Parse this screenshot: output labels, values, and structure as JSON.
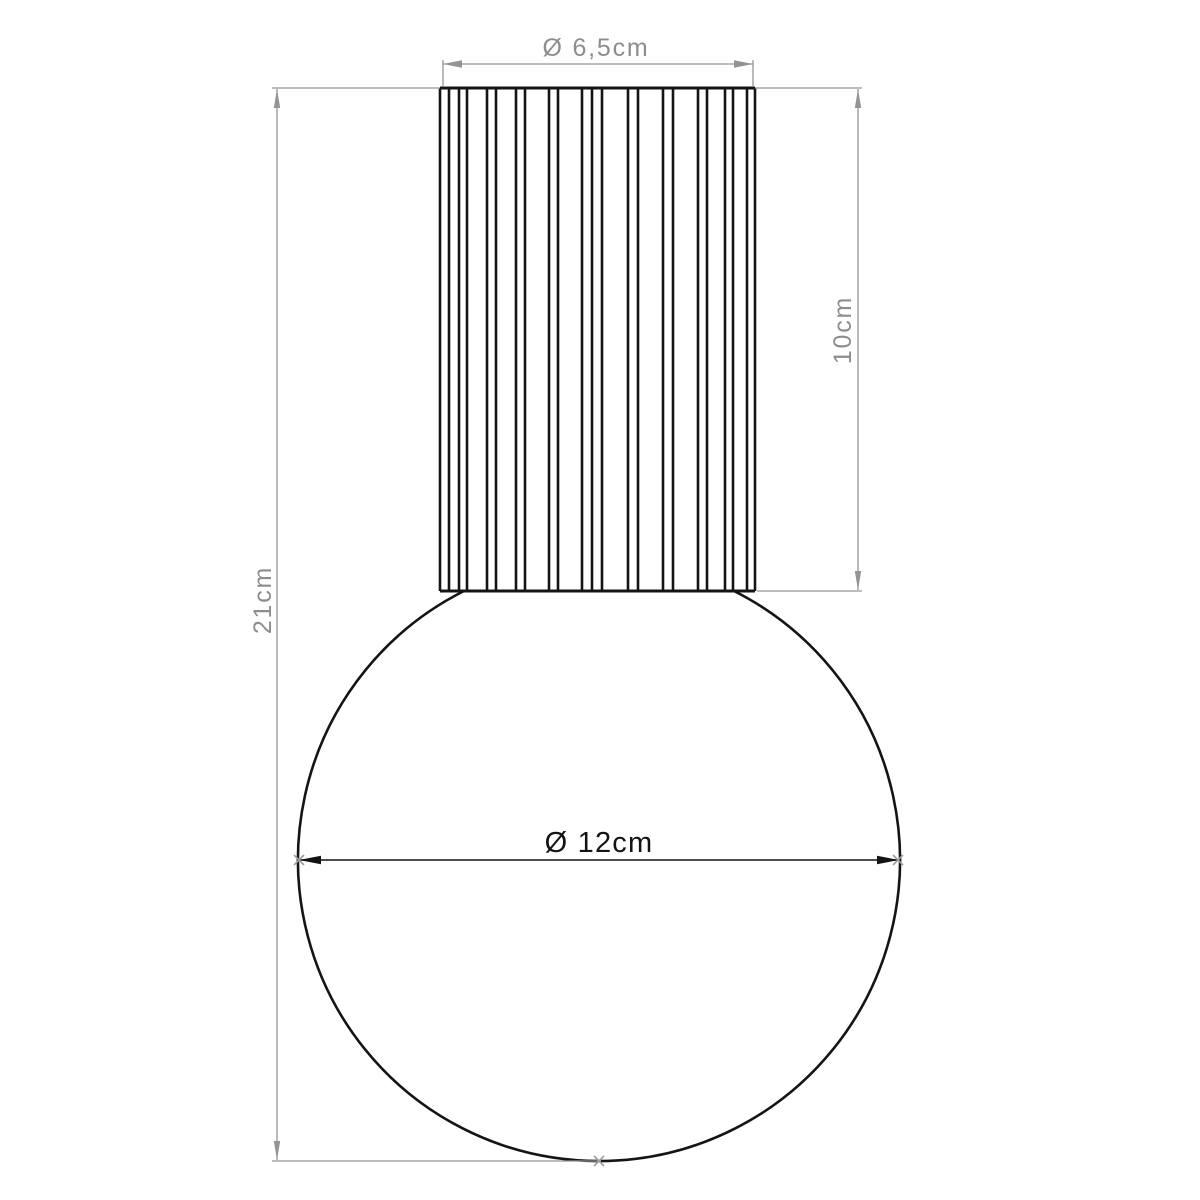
{
  "drawing": {
    "dimensions": {
      "top_diameter": {
        "label": "Ø 6,5cm",
        "value_cm": 6.5
      },
      "shade_height": {
        "label": "10cm",
        "value_cm": 10
      },
      "total_height": {
        "label": "21cm",
        "value_cm": 21
      },
      "globe_diameter": {
        "label": "Ø 12cm",
        "value_cm": 12
      }
    },
    "colors": {
      "outline": "#141414",
      "dimension_lines": "#949494",
      "dimension_text": "#8d8d8d",
      "background": "#ffffff"
    },
    "shade_ribs_x": [
      440,
      449,
      459,
      467,
      487,
      496,
      516,
      525,
      549,
      558,
      582,
      592,
      602,
      628,
      638,
      663,
      673,
      698,
      707,
      725,
      733,
      747,
      755
    ],
    "shade_top_y": 88,
    "shade_bottom_y": 591
  }
}
